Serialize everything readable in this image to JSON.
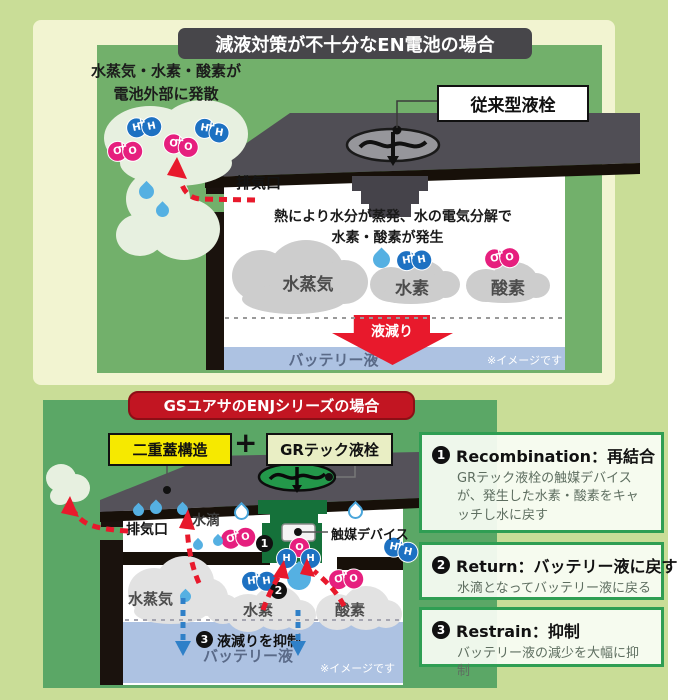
{
  "molecules": {
    "h": "H",
    "o": "O",
    "plus": "+"
  },
  "steps": {
    "s1": "1",
    "s2": "2",
    "s3": "3"
  },
  "top_panel": {
    "title": "減液対策が不十分なEN電池の場合",
    "escape_line1": "水蒸気・水素・酸素が",
    "escape_line2": "電池外部に発散",
    "plug_label": "従来型液栓",
    "vent_label": "排気口",
    "heat_line1": "熱により水分が蒸発、水の電気分解で",
    "heat_line2": "水素・酸素が発生",
    "cloud_vapor": "水蒸気",
    "cloud_hydrogen": "水素",
    "cloud_oxygen": "酸素",
    "drop_label": "液減り",
    "liquid_label": "バッテリー液",
    "disclaimer": "※イメージです"
  },
  "bottom_panel": {
    "title": "GSユアサのENJシリーズの場合",
    "double_lid_label": "二重蓋構造",
    "plus": "+",
    "gr_plug_label": "GRテック液栓",
    "vent_label": "排気口",
    "droplet_label": "水滴",
    "catalyst_label": "触媒デバイス",
    "cloud_vapor": "水蒸気",
    "cloud_hydrogen": "水素",
    "cloud_oxygen": "酸素",
    "restrain_label": "液減りを抑制",
    "liquid_label": "バッテリー液",
    "disclaimer": "※イメージです"
  },
  "info_boxes": [
    {
      "num": "1",
      "heading": "Recombination：再結合",
      "body": "GRテック液栓の触媒デバイスが、発生した水素・酸素をキャッチし水に戻す"
    },
    {
      "num": "2",
      "heading": "Return：バッテリー液に戻す",
      "body": "水滴となってバッテリー液に戻る"
    },
    {
      "num": "3",
      "heading": "Restrain：抑制",
      "body": "バッテリー液の減少を大幅に抑制"
    }
  ],
  "colors": {
    "page_bg": "#c9dd97",
    "panel_cream": "#f2f4d1",
    "panel_green_top": "#72b06b",
    "panel_green_bottom": "#5ba766",
    "banner_dark": "#47464a",
    "banner_red": "#c21522",
    "liquid_blue": "#adc2e2",
    "arrow_red": "#e8192c",
    "arrow_blue": "#2f80c8",
    "molecule_blue": "#1d71c2",
    "molecule_pink": "#e61f7e",
    "catalyst_green": "#15713a",
    "highlight_yellow": "#f6e900",
    "box_border_green": "#2f9e53"
  }
}
